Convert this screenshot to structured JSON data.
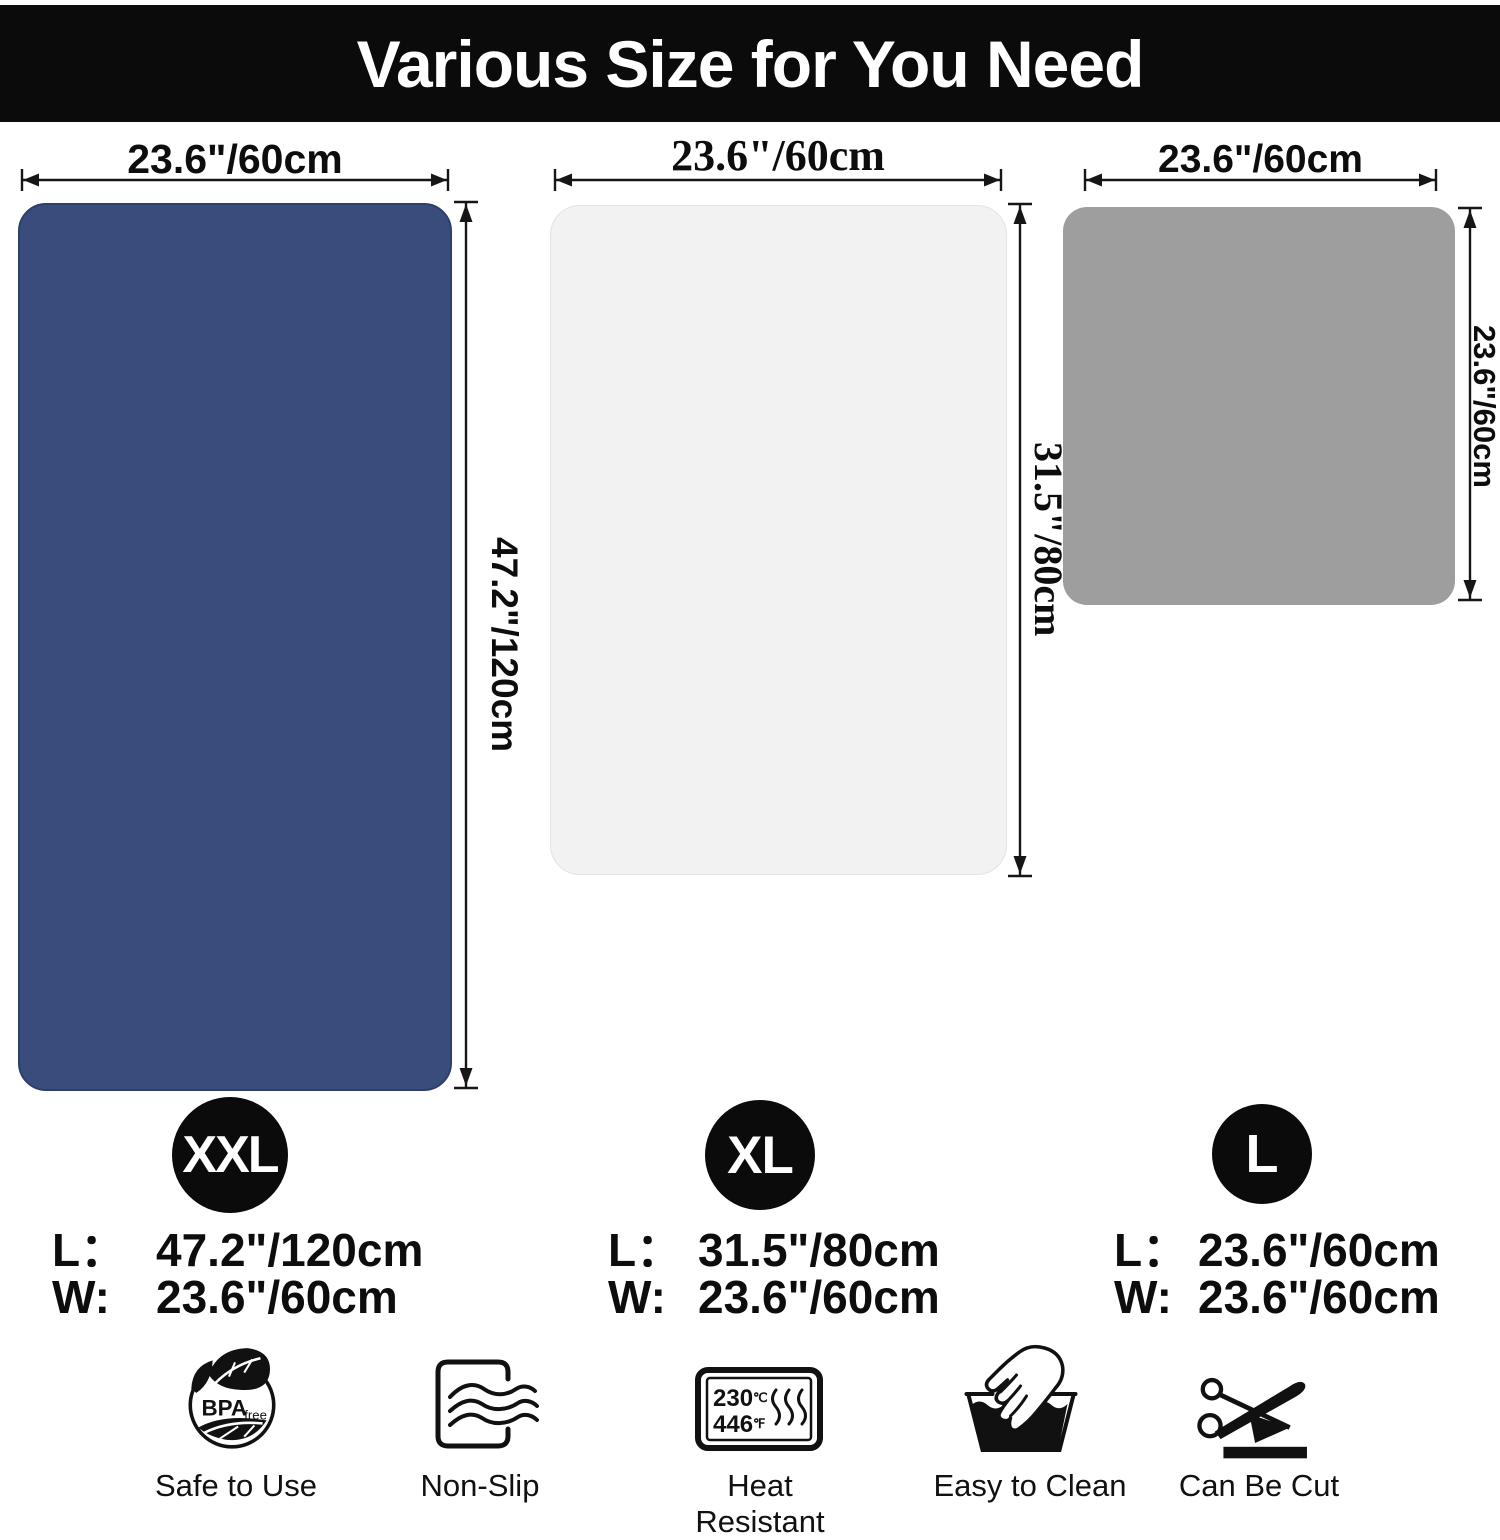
{
  "header": {
    "title": "Various Size for You Need"
  },
  "mats": [
    {
      "name": "XXL",
      "width_label": "23.6\"/60cm",
      "height_label": "47.2\"/120cm",
      "spec_l_label": "L：",
      "spec_l_value": "47.2\"/120cm",
      "spec_w_label": "W:",
      "spec_w_value": "23.6\"/60cm"
    },
    {
      "name": "XL",
      "width_label": "23.6\"/60cm",
      "height_label": "31.5\"/80cm",
      "spec_l_label": "L：",
      "spec_l_value": "31.5\"/80cm",
      "spec_w_label": "W:",
      "spec_w_value": "23.6\"/60cm"
    },
    {
      "name": "L",
      "width_label": "23.6\"/60cm",
      "height_label": "23.6\"/60cm",
      "spec_l_label": "L：",
      "spec_l_value": "23.6\"/60cm",
      "spec_w_label": "W:",
      "spec_w_value": "23.6\"/60cm"
    }
  ],
  "colors": {
    "header_bg": "#0b0b0b",
    "mat_xxl": "#3a4c7c",
    "mat_xxl_border": "#2e3f69",
    "mat_xl": "#f2f2f2",
    "mat_xl_border": "#e3e3e3",
    "mat_l": "#9e9e9e"
  },
  "features": [
    {
      "icon": "bpa-free-icon",
      "label": "Safe to Use"
    },
    {
      "icon": "non-slip-icon",
      "label": "Non-Slip"
    },
    {
      "icon": "heat-resistant-icon",
      "label": "Heat Resistant"
    },
    {
      "icon": "easy-to-clean-icon",
      "label": "Easy to Clean"
    },
    {
      "icon": "can-be-cut-icon",
      "label": "Can Be Cut"
    }
  ],
  "bpa_icon": {
    "bold": "BPA",
    "small": "free"
  },
  "heat_icon": {
    "celsius": "230",
    "celsius_unit": "℃",
    "fahrenheit": "446",
    "fahrenheit_unit": "℉"
  }
}
